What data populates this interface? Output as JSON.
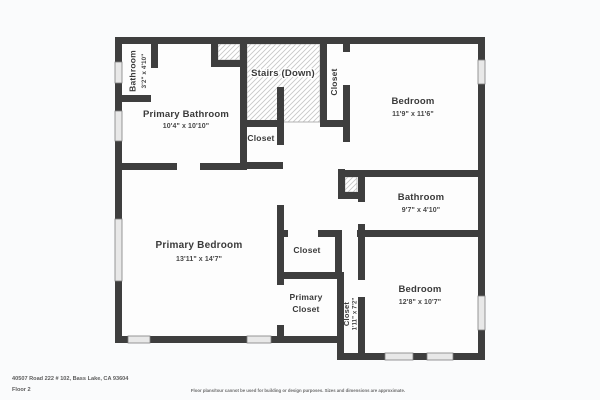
{
  "colors": {
    "wall": "#3e3e3e",
    "room_fill": "#fdfdfd",
    "canvas_bg": "#fafbfc",
    "hatch_line": "#c6c6c6",
    "window_fill": "#e8e8e8",
    "label": "#3a3a3a",
    "dims": "#474747",
    "footer_text": "#5c5c5c",
    "disclaimer_text": "#6b6b6b"
  },
  "rooms": {
    "bathroom_top_left": {
      "name": "Bathroom",
      "dims": "3'2\" x 4'10\""
    },
    "primary_bathroom": {
      "name": "Primary Bathroom",
      "dims": "10'4\" x 10'10\""
    },
    "stairs": {
      "name": "Stairs (Down)"
    },
    "closet_top_right": {
      "name": "Closet"
    },
    "bedroom_top_right": {
      "name": "Bedroom",
      "dims": "11'9\" x 11'6\""
    },
    "closet_under_stairs": {
      "name": "Closet"
    },
    "bathroom_right": {
      "name": "Bathroom",
      "dims": "9'7\" x 4'10\""
    },
    "primary_bedroom": {
      "name": "Primary Bedroom",
      "dims": "13'11\" x 14'7\""
    },
    "closet_hall": {
      "name": "Closet"
    },
    "primary_closet": {
      "line1": "Primary",
      "line2": "Closet"
    },
    "closet_narrow": {
      "name": "Closet",
      "dims": "1'11\" x 7'2\""
    },
    "bedroom_bottom_right": {
      "name": "Bedroom",
      "dims": "12'8\" x 10'7\""
    }
  },
  "footer": {
    "address": "40507 Road 222 # 102, Bass Lake, CA 93604",
    "floor_label": "Floor 2",
    "disclaimer": "Floor plans/tour cannot be used for building or design purposes. Sizes and dimensions are approximate."
  }
}
